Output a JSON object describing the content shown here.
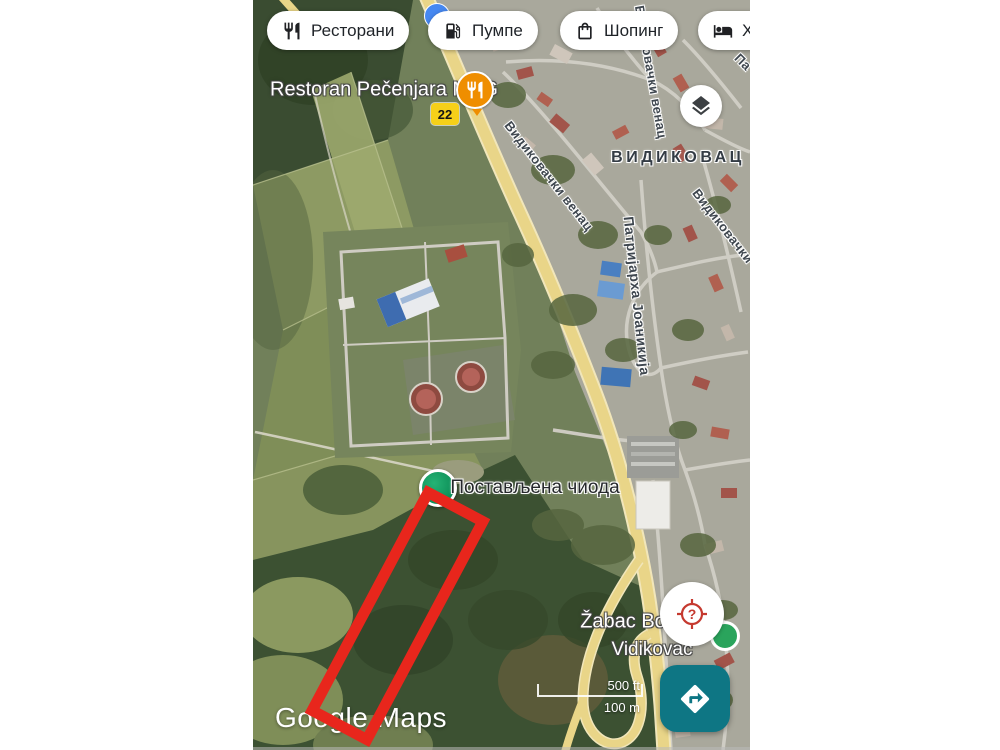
{
  "chips": {
    "items": [
      {
        "label": "Ресторани",
        "icon": "restaurant-icon"
      },
      {
        "label": "Пумпе",
        "icon": "gas-pump-icon"
      },
      {
        "label": "Шопинг",
        "icon": "shopping-bag-icon"
      },
      {
        "label": "Х",
        "icon": "hotel-bed-icon"
      }
    ]
  },
  "map_labels": {
    "restaurant_poi": "Restoran Pečenjara MAG",
    "route_number": "22",
    "district": "ВИДИКОВАЦ",
    "street_venac_top": "Видиковачки венац",
    "street_venac_diag": "Видиковачки венац",
    "street_patrijarha": "Патријарха Јоаникија",
    "street_venac_right": "Видиковачки",
    "street_partial_top_right": "Па",
    "pin": "Постављена чиода",
    "store": "Žabac Bov",
    "area": "Vidikovac"
  },
  "fabs": {
    "help_glyph": "?"
  },
  "scale_bar": {
    "imperial": "500 ft",
    "metric": "100 m"
  },
  "watermark": "Google Maps",
  "colors": {
    "annotation_red": "#e8261c",
    "accent_teal": "#0e7684",
    "pin_green": "#0d8f58",
    "poi_orange": "#ef8e00",
    "route_yellow": "#f6d019",
    "location_blue": "#4688f1",
    "help_red": "#c5392f"
  }
}
